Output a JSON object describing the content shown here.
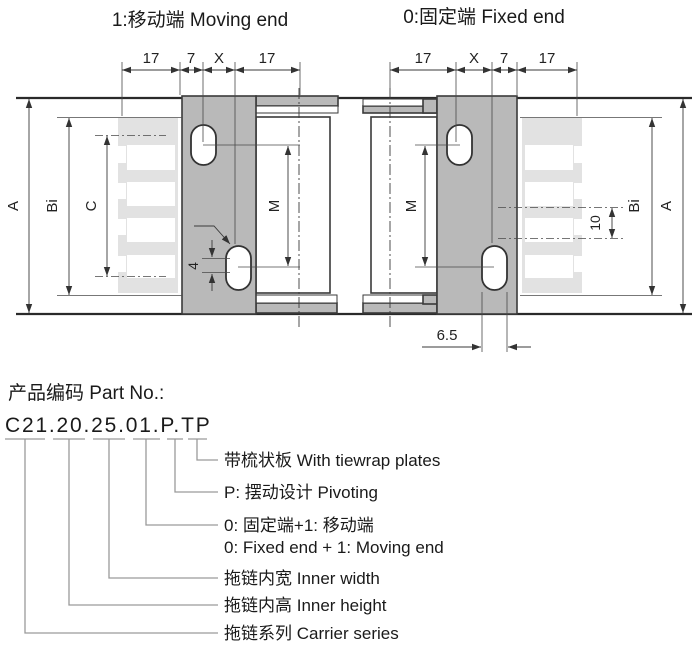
{
  "colors": {
    "bracket_fill": "#b9b9b9",
    "comb_fill": "#e2e2e2",
    "line": "#333333",
    "leader": "#9a9a9a",
    "background": "#ffffff"
  },
  "moving_end": {
    "title": "1:移动端 Moving end",
    "dim_1": "17",
    "dim_2": "7",
    "dim_3": "X",
    "dim_4": "17",
    "label_a": "A",
    "label_bi": "Bi",
    "label_c": "C",
    "label_m": "M",
    "label_offset": "4"
  },
  "fixed_end": {
    "title": "0:固定端 Fixed end",
    "dim_1": "17",
    "dim_2": "X",
    "dim_3": "7",
    "dim_4": "17",
    "label_m": "M",
    "label_bi": "Bi",
    "label_a": "A",
    "label_pitch": "10",
    "label_slot": "6.5"
  },
  "part_no": {
    "heading": "产品编码 Part No.:",
    "code": "C21.20.25.01.P.TP",
    "explanations": [
      {
        "text": "带梳状板 With tiewrap plates"
      },
      {
        "text": "P: 摆动设计 Pivoting"
      },
      {
        "text": "0: 固定端+1: 移动端",
        "text2": "0: Fixed end + 1: Moving end"
      },
      {
        "text": "拖链内宽 Inner width"
      },
      {
        "text": "拖链内高 Inner height"
      },
      {
        "text": "拖链系列 Carrier series"
      }
    ]
  }
}
